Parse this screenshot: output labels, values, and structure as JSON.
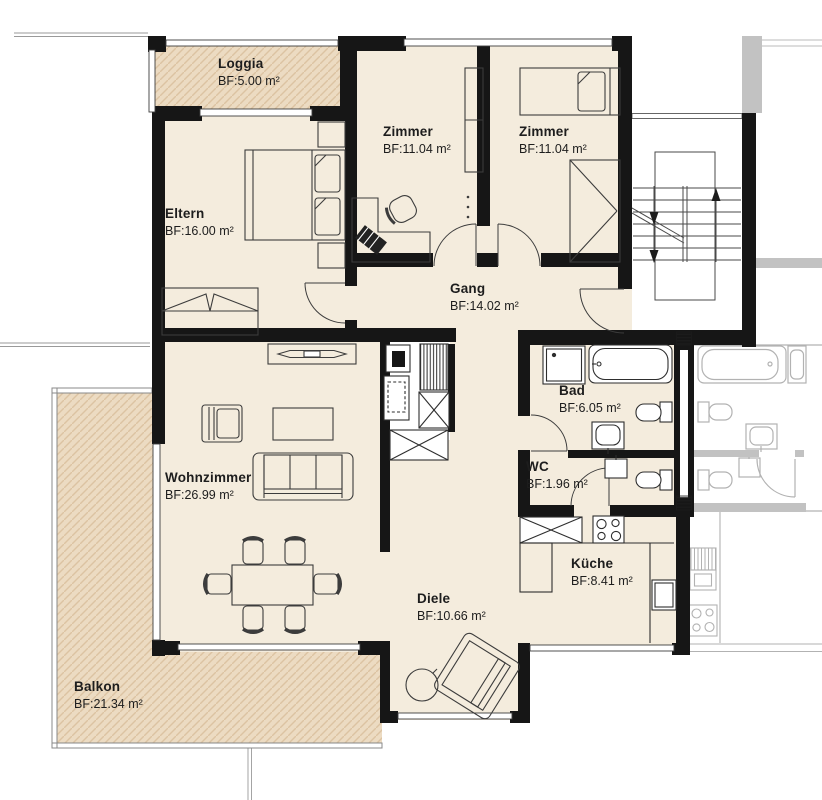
{
  "plan_title": "Apartment floor plan",
  "rooms": {
    "loggia": {
      "name": "Loggia",
      "area": "BF:5.00 m²"
    },
    "zimmer1": {
      "name": "Zimmer",
      "area": "BF:11.04 m²"
    },
    "zimmer2": {
      "name": "Zimmer",
      "area": "BF:11.04 m²"
    },
    "eltern": {
      "name": "Eltern",
      "area": "BF:16.00 m²"
    },
    "gang": {
      "name": "Gang",
      "area": "BF:14.02 m²"
    },
    "bad": {
      "name": "Bad",
      "area": "BF:6.05 m²"
    },
    "wc": {
      "name": "WC",
      "area": "BF:1.96 m²"
    },
    "wohnzimmer": {
      "name": "Wohnzimmer",
      "area": "BF:26.99 m²"
    },
    "kueche": {
      "name": "Küche",
      "area": "BF:8.41 m²"
    },
    "diele": {
      "name": "Diele",
      "area": "BF:10.66 m²"
    },
    "balkon": {
      "name": "Balkon",
      "area": "BF:21.34 m²"
    }
  },
  "colors": {
    "wall": "#161616",
    "room_fill": "#f4ecdd",
    "outdoor_fill": "#ecdbc2",
    "hatch_line": "#dcc3a2",
    "neighbor_line": "#b2b2b2",
    "text": "#1d1d1d"
  }
}
